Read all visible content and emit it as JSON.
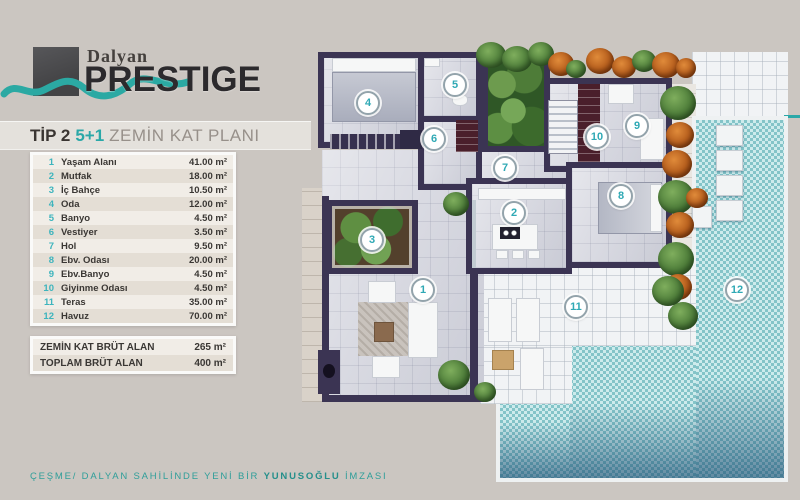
{
  "brand": {
    "name_top": "Dalyan",
    "name_main": "PRESTIGE"
  },
  "title": {
    "type": "TİP 2",
    "units": "5+1",
    "plan": "ZEMİN KAT PLANI"
  },
  "rooms": [
    {
      "num": "1",
      "name": "Yaşam Alanı",
      "area": "41.00 m²"
    },
    {
      "num": "2",
      "name": "Mutfak",
      "area": "18.00 m²"
    },
    {
      "num": "3",
      "name": "İç Bahçe",
      "area": "10.50 m²"
    },
    {
      "num": "4",
      "name": "Oda",
      "area": "12.00 m²"
    },
    {
      "num": "5",
      "name": "Banyo",
      "area": "4.50 m²"
    },
    {
      "num": "6",
      "name": "Vestiyer",
      "area": "3.50 m²"
    },
    {
      "num": "7",
      "name": "Hol",
      "area": "9.50 m²"
    },
    {
      "num": "8",
      "name": "Ebv. Odası",
      "area": "20.00 m²"
    },
    {
      "num": "9",
      "name": "Ebv.Banyo",
      "area": "4.50 m²"
    },
    {
      "num": "10",
      "name": "Giyinme Odası",
      "area": "4.50 m²"
    },
    {
      "num": "11",
      "name": "Teras",
      "area": "35.00 m²"
    },
    {
      "num": "12",
      "name": "Havuz",
      "area": "70.00 m²"
    }
  ],
  "summary": [
    {
      "label": "ZEMİN KAT BRÜT ALAN",
      "value": "265 m²"
    },
    {
      "label": "TOPLAM BRÜT ALAN",
      "value": "400 m²"
    }
  ],
  "footer": {
    "pre": "ÇEŞME/ DALYAN SAHİLİNDE YENİ BİR ",
    "brand": "YUNUSOĞLU",
    "post": " İMZASI"
  },
  "plan": {
    "markers": [
      "1",
      "2",
      "3",
      "4",
      "5",
      "6",
      "7",
      "8",
      "9",
      "10",
      "11",
      "12"
    ]
  },
  "colors": {
    "accent_teal": "#2aa8a8",
    "wall": "#3b3453",
    "pool": "#9bd6d8",
    "background": "#cbc6c1",
    "table_number": "#3db4bd"
  }
}
